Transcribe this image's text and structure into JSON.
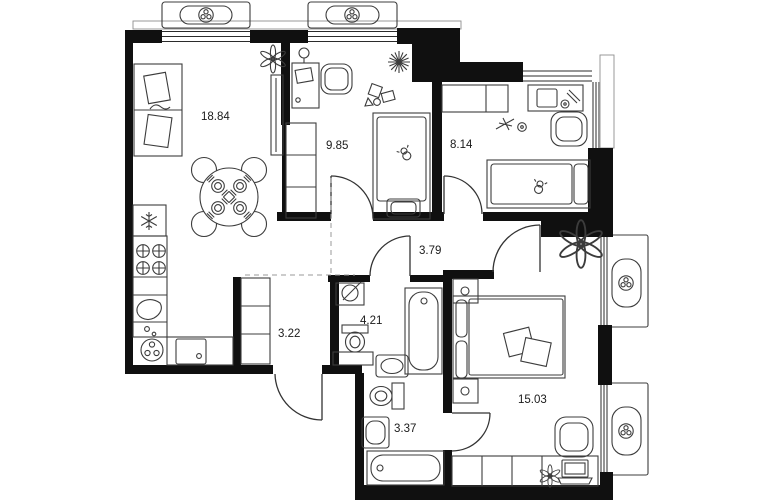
{
  "plan_title": "apartment-floor-plan",
  "rooms": {
    "living_kitchen": {
      "area": "18.84"
    },
    "child_room_1": {
      "area": "9.85"
    },
    "child_room_2": {
      "area": "8.14"
    },
    "hallway": {
      "area": "3.79"
    },
    "corridor": {
      "area": "3.22"
    },
    "bathroom": {
      "area": "4.21"
    },
    "bedroom": {
      "area": "15.03"
    },
    "wc": {
      "area": "3.37"
    }
  },
  "icons": {
    "ac_unit": "fan-icon",
    "fridge": "snowflake-icon",
    "ceiling_light": "starburst-icon",
    "plant": "flower-icon",
    "electrical_panel": "circle-slash-icon",
    "stove": "burner-cross-icon",
    "place_setting": "plate-fork-knife-icon"
  },
  "colors": {
    "wall": "#101010",
    "furniture_line": "#3c3c3c",
    "door_line": "#333333",
    "dash_line": "#9a9a9a",
    "label": "#1a1a1a",
    "background": "#ffffff"
  }
}
